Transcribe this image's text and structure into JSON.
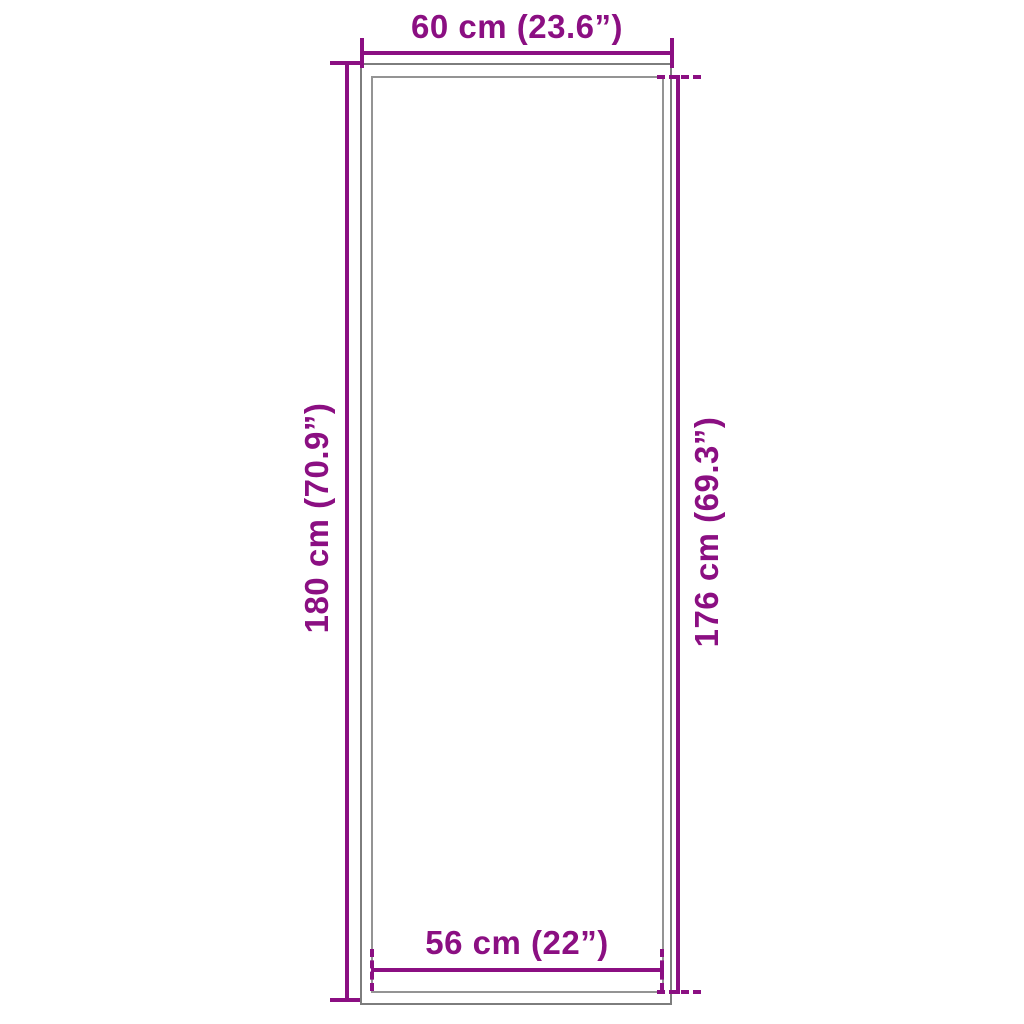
{
  "diagram": {
    "type": "product-dimension-diagram",
    "colors": {
      "accent": "#8b0f82",
      "frame_outer": "#7d7d7d",
      "frame_inner": "#949494",
      "background": "#ffffff"
    },
    "dimensions": {
      "top": {
        "label": "60 cm (23.6”)"
      },
      "left": {
        "label": "180 cm (70.9”)"
      },
      "right": {
        "label": "176 cm (69.3”)"
      },
      "bottom": {
        "label": "56 cm (22”)"
      }
    }
  }
}
